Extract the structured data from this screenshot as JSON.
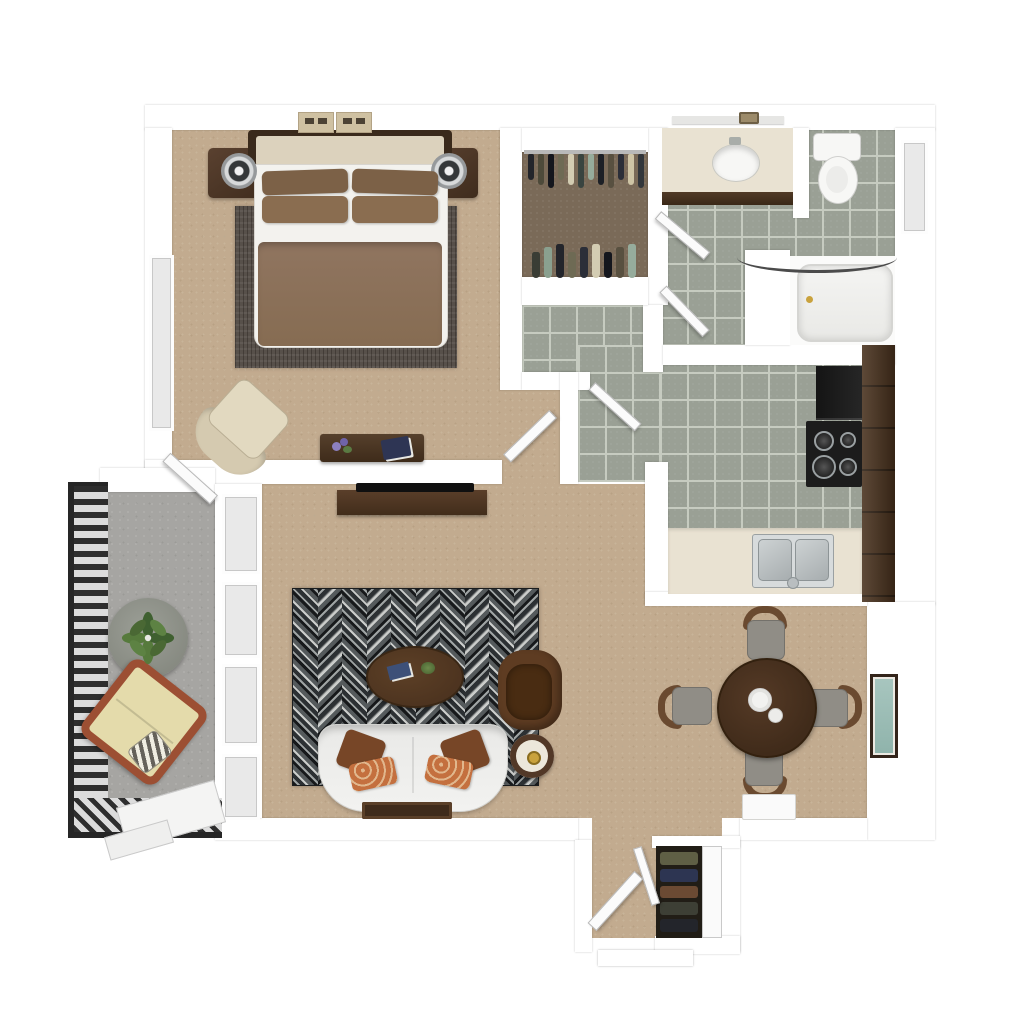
{
  "meta": {
    "kind": "3d-floor-plan-top-view",
    "description": "Top-down 3D rendering of a one-bedroom apartment floor plan with balcony",
    "visible_text": ""
  },
  "colors": {
    "wall": "#ffffff",
    "glass": "#e9e9e9",
    "door": "#fbfbfb",
    "carpet": "#c2ab8f",
    "tile": "#9aa095",
    "grout": "#c6cbc0",
    "closet_floor": "#7a6a58",
    "balcony_floor": "#a6a5a2",
    "wood_dark": "#4a3322",
    "wood_mid": "#6a4a30",
    "rug_dark": "#17191b",
    "rug_mid": "#2c3033",
    "rug_gray": "#9ea3a3",
    "rug_light": "#cbcdcb",
    "rug_slate": "#555a5c",
    "bedroom_rug": "#57504a",
    "duvet": "#8c7057",
    "pillow_tan": "#8a6d50",
    "headboard_cream": "#dcd2bd",
    "mattress": "#f3f2ee",
    "sofa": "#ececea",
    "leather": "#5e3c22",
    "pillow_brown": "#774627",
    "pillow_rust": "#c4703f",
    "counter_cream": "#e9e2d2",
    "appliance_black": "#1c1c1c",
    "steel": "#c2c7c9",
    "fixture_white": "#f7f7f5",
    "plant_green": "#4a6834",
    "lounge_wood": "#9c4f33",
    "lounge_cushion": "#e4dbab",
    "railing": "#2e2e2e",
    "art_frame": "#33241a",
    "art_teal": "#a8c6bf",
    "gold": "#c9a23d"
  },
  "rooms": {
    "bedroom": {
      "name": "Bedroom",
      "floor": "carpet",
      "furniture": [
        "bed with brown duvet and four pillows",
        "nightstand with lamp (left)",
        "nightstand with lamp (right)",
        "dark area rug",
        "cream accent chair",
        "bench with flowers and book",
        "two wall art panels",
        "window"
      ]
    },
    "closet": {
      "name": "Walk-in Closet",
      "floor": "dark wood",
      "furniture": [
        "clothes rod",
        "hanging garments top row",
        "hanging garments bottom row"
      ]
    },
    "vestibule": {
      "name": "Linen Closet",
      "floor": "tile",
      "furniture": []
    },
    "bathroom": {
      "name": "Bathroom",
      "floor": "tile",
      "furniture": [
        "vanity with oval sink",
        "mirror strip",
        "toilet",
        "bathtub",
        "curved shower rod",
        "window"
      ]
    },
    "hallway": {
      "name": "Hallway",
      "floor": "tile",
      "furniture": [
        "door leaves"
      ]
    },
    "kitchen": {
      "name": "Kitchen",
      "floor": "tile",
      "furniture": [
        "refrigerator",
        "range with burners",
        "tall cabinets",
        "counter with double sink"
      ]
    },
    "living": {
      "name": "Living Room",
      "floor": "carpet",
      "furniture": [
        "tv console with tv",
        "herringbone rug",
        "oval coffee table",
        "leather armchair",
        "white sofa with pillows",
        "round side table with lamp",
        "floor tray"
      ]
    },
    "dining": {
      "name": "Dining Area",
      "floor": "carpet",
      "furniture": [
        "round dining table",
        "four chairs",
        "plate",
        "cup",
        "framed wall art"
      ]
    },
    "balcony": {
      "name": "Balcony",
      "floor": "concrete",
      "furniture": [
        "metal railing",
        "round table",
        "potted plant",
        "wood lounge chair with striped pillow",
        "walkway"
      ]
    },
    "entry": {
      "name": "Entry",
      "floor": "carpet",
      "furniture": [
        "front door",
        "screen door leaf",
        "coat closet",
        "door mat",
        "front step"
      ]
    }
  },
  "closet": {
    "top_garments": [
      "#23252b",
      "#4d4a3a",
      "#14161d",
      "#6e6a54",
      "#d3ccb2",
      "#394440",
      "#96ac9c",
      "#1d2026",
      "#585040",
      "#2b2e38",
      "#cfc5a6",
      "#32363b"
    ],
    "bottom_garments": [
      "#3a3d35",
      "#8aa08f",
      "#23252b",
      "#6e6a54",
      "#2b2e38",
      "#d3ccb2",
      "#14161d",
      "#585040",
      "#96ac9c"
    ]
  },
  "entry_closet": {
    "coats": [
      "#5f5f45",
      "#2d3552",
      "#6b4a33",
      "#3d3f35",
      "#23252b"
    ]
  },
  "rug": {
    "columns": 10
  }
}
